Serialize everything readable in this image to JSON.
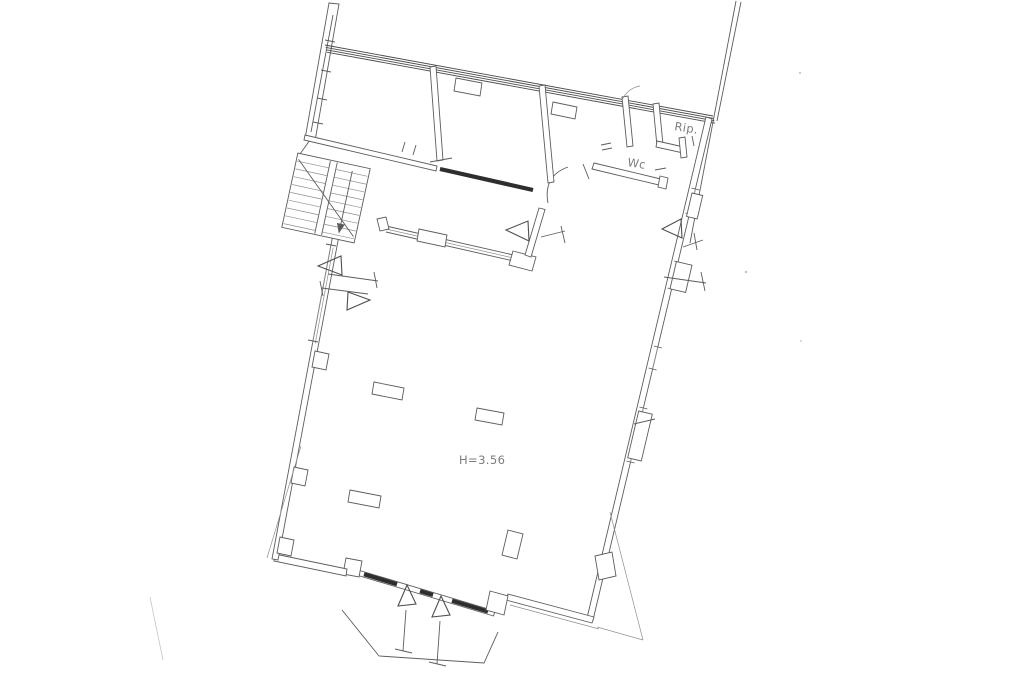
{
  "canvas": {
    "width": 1024,
    "height": 682,
    "background": "#ffffff",
    "ink": "#5c5c5c",
    "ink_dark": "#2e2e2e",
    "ink_light": "#8f8f8f",
    "artifact": "#c6c6c6"
  },
  "plan": {
    "type": "architectural-floor-plan-scan",
    "labels": {
      "storage": {
        "text": "Rip.",
        "x": 674,
        "y": 130
      },
      "toilet": {
        "text": "Wc",
        "x": 627,
        "y": 166
      },
      "ceiling_height": {
        "text": "H=3.56",
        "x": 459,
        "y": 464
      }
    },
    "symbols": {
      "stairs": "double-flight-staircase-with-down-arrow",
      "window_markers": "outlined-triangles-with-dimension-ticks",
      "entry": "recessed-storefront-with-two-door-triangles-and-porch-step",
      "party_wall": "hatched-multi-line-top-wall"
    }
  }
}
